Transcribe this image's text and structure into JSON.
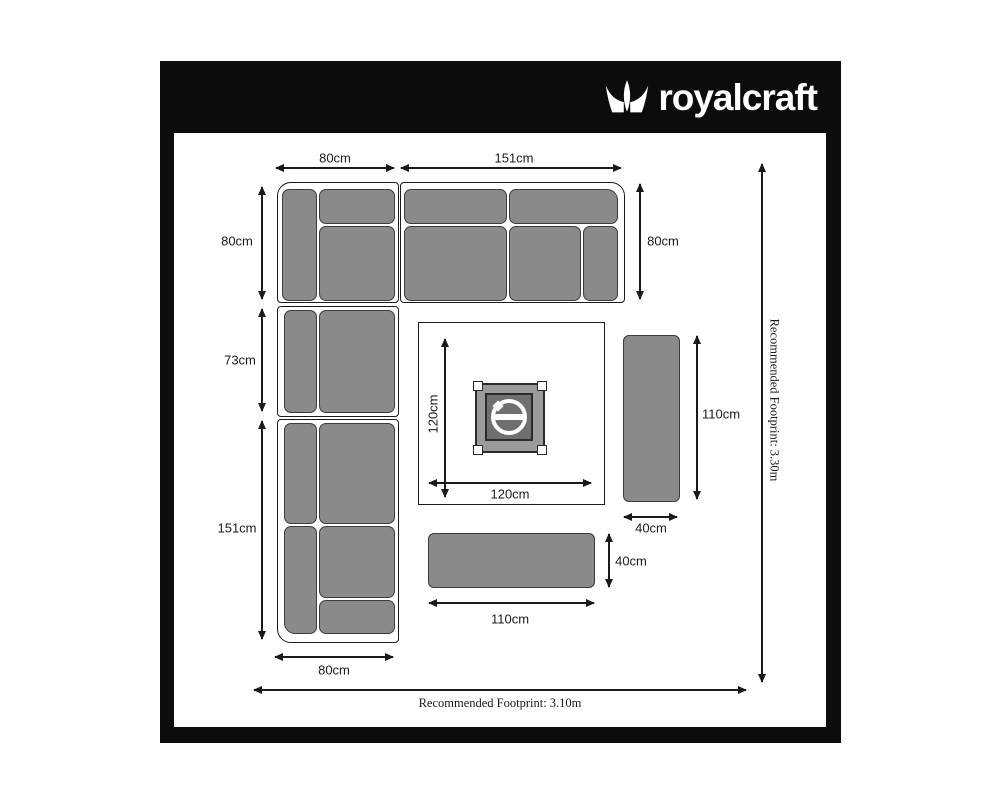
{
  "brand": {
    "name": "royalcraft"
  },
  "diagram": {
    "sofa": {
      "corner_width": "80cm",
      "right_section_width": "151cm",
      "corner_depth": "80cm",
      "right_section_depth": "80cm",
      "left_mid_section_height": "73cm",
      "left_bottom_section_height": "151cm",
      "left_section_width": "80cm"
    },
    "table": {
      "depth": "120cm",
      "width": "120cm"
    },
    "bench_right": {
      "length": "110cm",
      "width": "40cm"
    },
    "bench_bottom": {
      "width": "40cm",
      "length": "110cm"
    },
    "footprint": {
      "vertical": "Recommended Footprint: 3.30m",
      "horizontal": "Recommended Footprint: 3.10m"
    }
  },
  "colors": {
    "frame_black": "#0c0c0c",
    "cushion_gray": "#8a8a8a",
    "cushion_outline": "#3c3c3c",
    "line_black": "#1a1a1a",
    "white": "#ffffff"
  }
}
